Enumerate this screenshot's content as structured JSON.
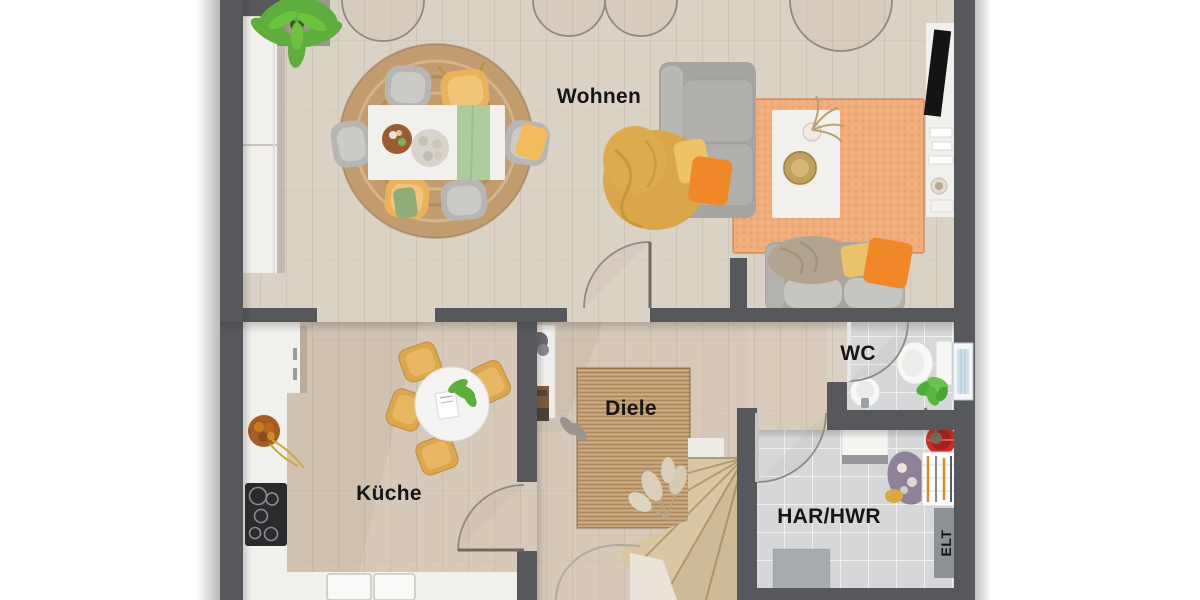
{
  "plan": {
    "type": "floor-plan",
    "room_labels": {
      "wohnen": "Wohnen",
      "kueche": "Küche",
      "diele": "Diele",
      "wc": "WC",
      "har_hwr": "HAR/HWR",
      "elt": "ELT"
    },
    "colors": {
      "wall": "#56585c",
      "floor_wood": "#dbd2c6",
      "floor_wood_warm": "#d7c9b9",
      "floor_tile": "#d5d7d8",
      "rug_jute": "#c29b6e",
      "rug_orange": "#f0ac7a",
      "sofa_gray": "#a6a5a2",
      "chair_yellow": "#e9b25b",
      "accent_orange": "#f0882a",
      "throw_mustard": "#d9a64a",
      "runner_sage": "#aecb9d",
      "plant_green": "#5fae3d",
      "furniture_white": "#f1f0ed",
      "label_text": "#161616"
    }
  }
}
